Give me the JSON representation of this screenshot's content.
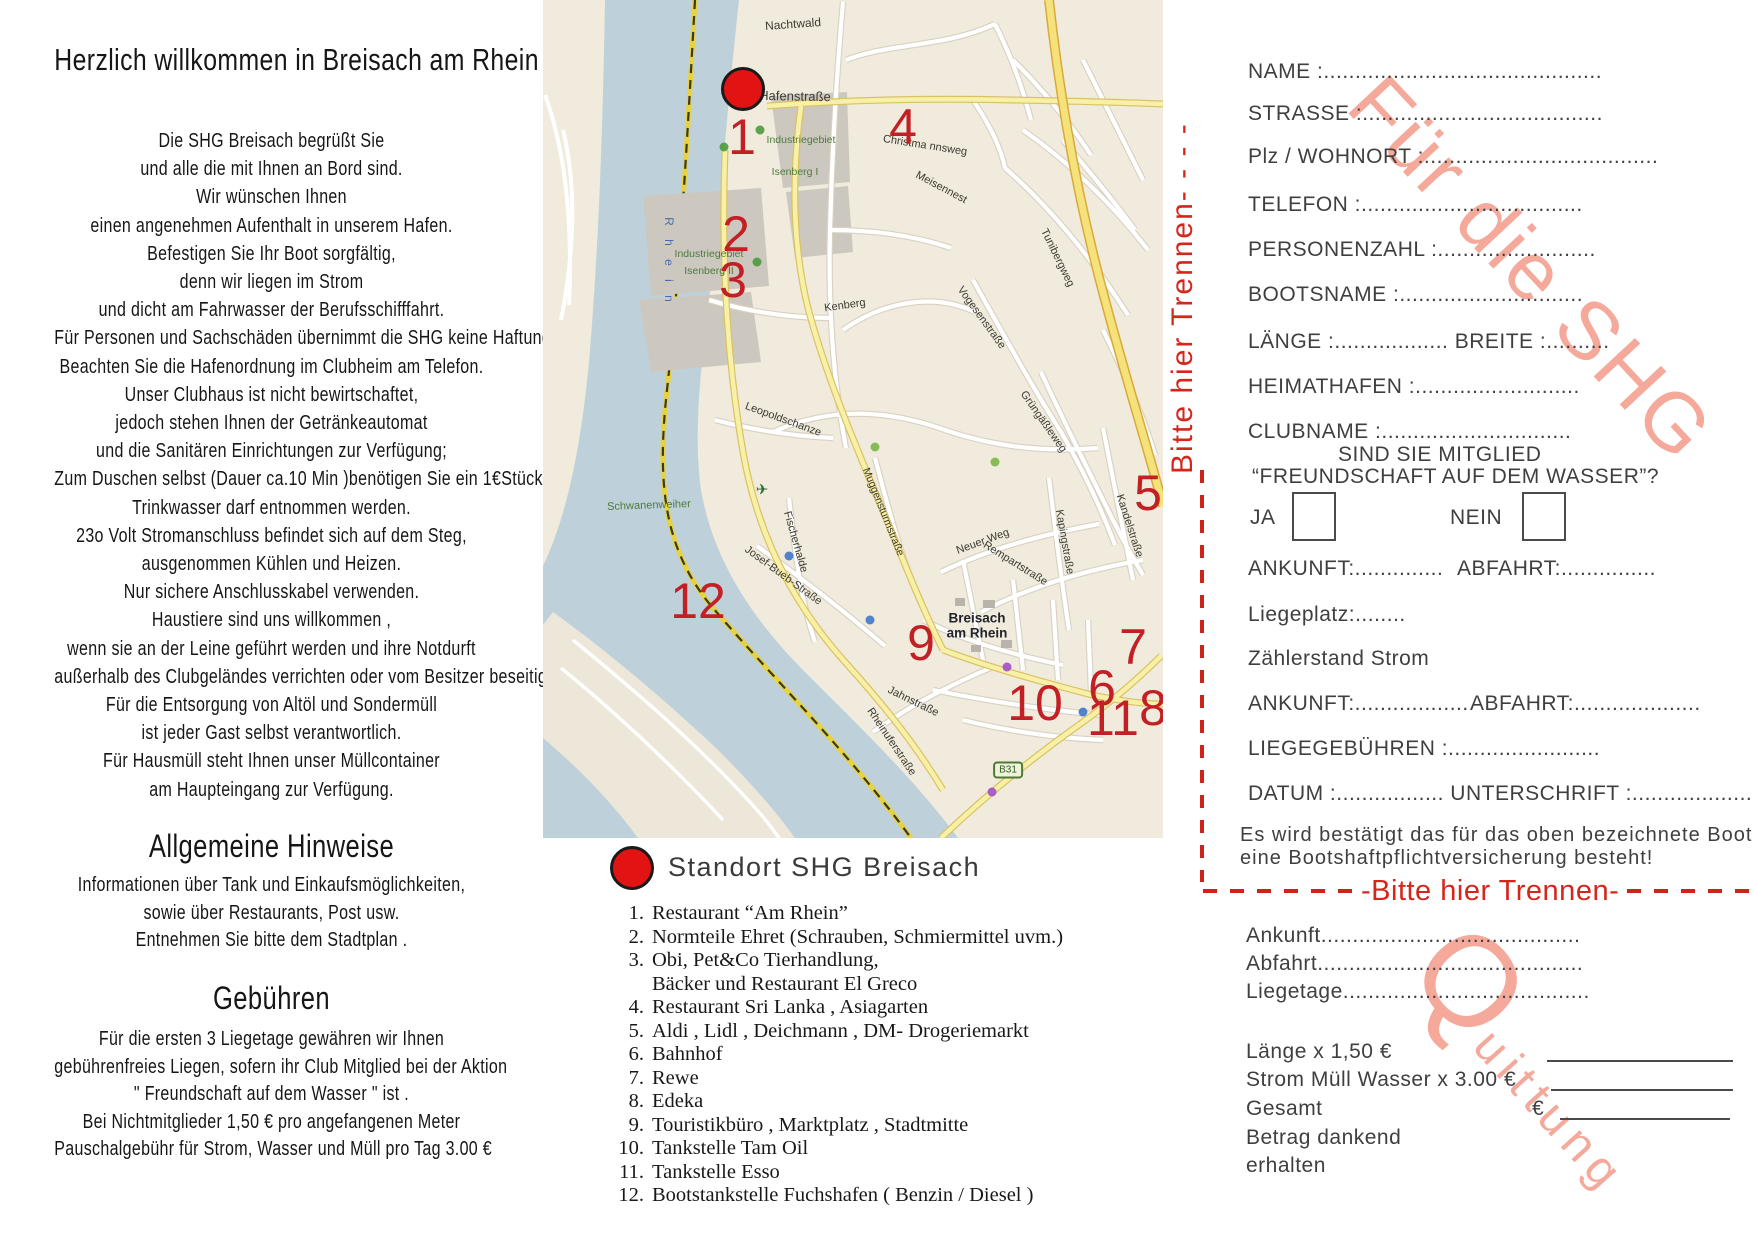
{
  "left_column": {
    "title": "Herzlich willkommen in Breisach am Rhein",
    "body_lines": [
      "Die SHG Breisach begrüßt Sie",
      "und alle die mit Ihnen an Bord sind.",
      "Wir wünschen Ihnen",
      "einen angenehmen Aufenthalt in unserem Hafen.",
      "Befestigen Sie Ihr Boot sorgfältig,",
      "denn wir liegen im Strom",
      "und dicht am Fahrwasser der Berufsschifffahrt.",
      "Für Personen und Sachschäden übernimmt die SHG keine Haftung.",
      "Beachten Sie die Hafenordnung im Clubheim am Telefon.",
      "Unser Clubhaus ist nicht bewirtschaftet,",
      "jedoch stehen Ihnen der Getränkeautomat",
      "und die Sanitären  Einrichtungen zur Verfügung;",
      "Zum Duschen selbst (Dauer ca.10 Min )benötigen Sie ein 1€Stück.",
      "Trinkwasser darf entnommen werden.",
      "23o Volt Stromanschluss befindet sich auf dem Steg,",
      "ausgenommen Kühlen und Heizen.",
      "Nur sichere Anschlusskabel verwenden.",
      "Haustiere sind uns willkommen ,",
      "wenn sie an der Leine geführt werden und ihre Notdurft",
      "außerhalb des Clubgeländes verrichten oder vom Besitzer beseitigt wird.",
      "Für die Entsorgung von Altöl und Sondermüll",
      "ist jeder Gast selbst verantwortlich.",
      "Für Hausmüll steht Ihnen unser Müllcontainer",
      "am Haupteingang zur Verfügung."
    ],
    "sections": [
      {
        "heading": "Allgemeine Hinweise",
        "lines": [
          "Informationen über Tank und Einkaufsmöglichkeiten,",
          "sowie über Restaurants, Post usw.",
          "Entnehmen Sie bitte dem Stadtplan ."
        ]
      },
      {
        "heading": "Gebühren",
        "lines": [
          "Für die ersten 3 Liegetage gewähren wir Ihnen",
          "gebührenfreies Liegen, sofern ihr Club Mitglied bei der Aktion",
          "\" Freundschaft auf dem Wasser \" ist .",
          "Bei Nichtmitglieder 1,50 € pro angefangenen  Meter",
          "Pauschalgebühr für Strom, Wasser und Müll pro Tag 3.00 €"
        ]
      }
    ]
  },
  "map": {
    "route_badge": "B31",
    "markers": [
      {
        "n": "1",
        "x": 199,
        "y": 137
      },
      {
        "n": "2",
        "x": 193,
        "y": 234
      },
      {
        "n": "3",
        "x": 190,
        "y": 280
      },
      {
        "n": "4",
        "x": 360,
        "y": 127
      },
      {
        "n": "5",
        "x": 605,
        "y": 493
      },
      {
        "n": "6",
        "x": 559,
        "y": 688
      },
      {
        "n": "7",
        "x": 590,
        "y": 647
      },
      {
        "n": "8",
        "x": 610,
        "y": 708
      },
      {
        "n": "9",
        "x": 378,
        "y": 643
      },
      {
        "n": "10",
        "x": 492,
        "y": 703
      },
      {
        "n": "11",
        "x": 570,
        "y": 718
      },
      {
        "n": "12",
        "x": 155,
        "y": 601
      }
    ],
    "labels": [
      {
        "t": "Nachtwald",
        "x": 250,
        "y": 24,
        "r": -4,
        "s": 12
      },
      {
        "t": "Hafenstraße",
        "x": 252,
        "y": 96,
        "r": 1,
        "s": 13
      },
      {
        "t": "Industriegebiet",
        "x": 258,
        "y": 140,
        "s": 10.5,
        "c": "#4c7a3c"
      },
      {
        "t": "Isenberg I",
        "x": 252,
        "y": 172,
        "s": 10.5,
        "c": "#4c7a3c"
      },
      {
        "t": "Industriegebiet",
        "x": 166,
        "y": 254,
        "s": 10.5,
        "c": "#4c7a3c"
      },
      {
        "t": "Isenberg II",
        "x": 166,
        "y": 271,
        "s": 10.5,
        "c": "#4c7a3c"
      },
      {
        "t": "Christma nnsweg",
        "x": 382,
        "y": 146,
        "r": 9,
        "s": 11
      },
      {
        "t": "Meisennest",
        "x": 398,
        "y": 188,
        "r": 28,
        "s": 11
      },
      {
        "t": "Tunibergweg",
        "x": 514,
        "y": 258,
        "r": 64,
        "s": 11
      },
      {
        "t": "Vogesenstraße",
        "x": 438,
        "y": 318,
        "r": 54,
        "s": 11
      },
      {
        "t": "Grüngäßleweg",
        "x": 500,
        "y": 422,
        "r": 55,
        "s": 11
      },
      {
        "t": "Kenberg",
        "x": 302,
        "y": 306,
        "r": -8,
        "s": 11
      },
      {
        "t": "Leopoldschanze",
        "x": 240,
        "y": 420,
        "r": 20,
        "s": 11
      },
      {
        "t": "Muggensturmstraße",
        "x": 340,
        "y": 512,
        "r": 68,
        "s": 10.5
      },
      {
        "t": "Schwanenweiher",
        "x": 106,
        "y": 506,
        "r": -2,
        "s": 11,
        "c": "#4c7a3c"
      },
      {
        "t": "✈",
        "x": 219,
        "y": 490,
        "s": 15,
        "c": "#2f6b2f"
      },
      {
        "t": "Fischerhalde",
        "x": 252,
        "y": 542,
        "r": 74,
        "s": 11
      },
      {
        "t": "Josef-Bueb-Straße",
        "x": 240,
        "y": 576,
        "r": 36,
        "s": 11
      },
      {
        "t": "Neuer Weg",
        "x": 440,
        "y": 542,
        "r": -20,
        "s": 11
      },
      {
        "t": "Kapingstraße",
        "x": 521,
        "y": 542,
        "r": 80,
        "s": 11
      },
      {
        "t": "Kandelstraße",
        "x": 586,
        "y": 526,
        "r": 72,
        "s": 11
      },
      {
        "t": "Rempartstraße",
        "x": 472,
        "y": 564,
        "r": 32,
        "s": 11
      },
      {
        "t": "Jahnstraße",
        "x": 370,
        "y": 702,
        "r": 26,
        "s": 11
      },
      {
        "t": "Rheinuferstraße",
        "x": 348,
        "y": 742,
        "r": 56,
        "s": 11
      },
      {
        "t": "Breisach",
        "x": 434,
        "y": 618,
        "s": 13.5,
        "w": 1,
        "c": "#23232b"
      },
      {
        "t": "am Rhein",
        "x": 434,
        "y": 633,
        "s": 13.5,
        "w": 1,
        "c": "#23232b"
      },
      {
        "t": "R h e i n",
        "x": 126,
        "y": 262,
        "r": 90,
        "s": 12,
        "c": "#4a6db0",
        "ls": 5
      }
    ],
    "poi_dots": [
      {
        "x": 217,
        "y": 130,
        "c": "#4d9a3d"
      },
      {
        "x": 181,
        "y": 147,
        "c": "#4d9a3d"
      },
      {
        "x": 214,
        "y": 262,
        "c": "#4d9a3d"
      },
      {
        "x": 332,
        "y": 447,
        "c": "#7ab648"
      },
      {
        "x": 452,
        "y": 462,
        "c": "#7ab648"
      },
      {
        "x": 327,
        "y": 620,
        "c": "#3f77c8"
      },
      {
        "x": 246,
        "y": 556,
        "c": "#3f77c8"
      },
      {
        "x": 540,
        "y": 712,
        "c": "#3f77c8"
      },
      {
        "x": 464,
        "y": 667,
        "c": "#a14fc8"
      },
      {
        "x": 449,
        "y": 792,
        "c": "#a14fc8"
      }
    ]
  },
  "legend": {
    "station_label": "Standort SHG Breisach",
    "items": [
      {
        "n": "1.",
        "t": "Restaurant “Am Rhein”"
      },
      {
        "n": "2.",
        "t": "Normteile Ehret (Schrauben, Schmiermittel uvm.)"
      },
      {
        "n": "3.",
        "t": "Obi, Pet&Co Tierhandlung,"
      },
      {
        "n": "",
        "t": "Bäcker und Restaurant El Greco"
      },
      {
        "n": "4.",
        "t": "Restaurant Sri Lanka , Asiagarten"
      },
      {
        "n": "5.",
        "t": "Aldi , Lidl , Deichmann , DM- Drogeriemarkt"
      },
      {
        "n": "6.",
        "t": "Bahnhof"
      },
      {
        "n": "7.",
        "t": "Rewe"
      },
      {
        "n": "8.",
        "t": "Edeka"
      },
      {
        "n": "9.",
        "t": "Touristikbüro , Marktplatz , Stadtmitte"
      },
      {
        "n": "10.",
        "t": "Tankstelle Tam Oil"
      },
      {
        "n": "11.",
        "t": "Tankstelle Esso"
      },
      {
        "n": "12.",
        "t": "Bootstankstelle Fuchshafen ( Benzin / Diesel )"
      }
    ]
  },
  "form": {
    "name_line": "NAME :............................................",
    "strasse_line": "STRASSE :......................................",
    "plz_line": "Plz / WOHNORT :.....................................",
    "telefon_line": "TELEFON :...................................",
    "personen_line": "PERSONENZAHL :.........................",
    "bootsname_line": "BOOTSNAME :.............................",
    "laenge_line": "LÄNGE :.................. BREITE :..........",
    "heimathafen_line": "HEIMATHAFEN :..........................",
    "clubname_line": "CLUBNAME :..............................",
    "mitglied_line1": "SIND SIE MITGLIED",
    "mitglied_line2": "“FREUNDSCHAFT AUF DEM WASSER”?",
    "ja_label": "JA",
    "nein_label": "NEIN",
    "ankunft1": "ANKUNFT:..............",
    "abfahrt1": "ABFAHRT:...............",
    "liegeplatz_line": "Liegeplatz:........",
    "zaehlerstand_line": "Zählerstand Strom",
    "ankunft2": "ANKUNFT:..................",
    "abfahrt2": "ABFAHRT:....................",
    "liegegebuehren_line": "LIEGEGEBÜHREN :........................",
    "datum_line": "DATUM :................. UNTERSCHRIFT :....................",
    "confirm_line1": "Es wird bestätigt das für das oben bezeichnete Boot",
    "confirm_line2": "eine Bootshaftpflichtversicherung besteht!"
  },
  "separator": {
    "vertical_text": "Bitte hier Trennen- - - - ",
    "horizontal_text": "-Bitte hier Trennen-"
  },
  "receipt": {
    "ankunft_line": "Ankunft.........................................",
    "abfahrt_line": "Abfahrt..........................................",
    "liegetage_line": "Liegetage.......................................",
    "laenge_row": "Länge x 1,50 €",
    "strom_row": "Strom Müll Wasser x 3.00 €",
    "gesamt_row": "Gesamt",
    "euro_sign": "€",
    "betrag_line1": "Betrag dankend",
    "betrag_line2": "erhalten"
  },
  "watermarks": {
    "diagonal": "Für die SHG",
    "receipt_initial": "Q",
    "receipt_rest": "uittung"
  }
}
